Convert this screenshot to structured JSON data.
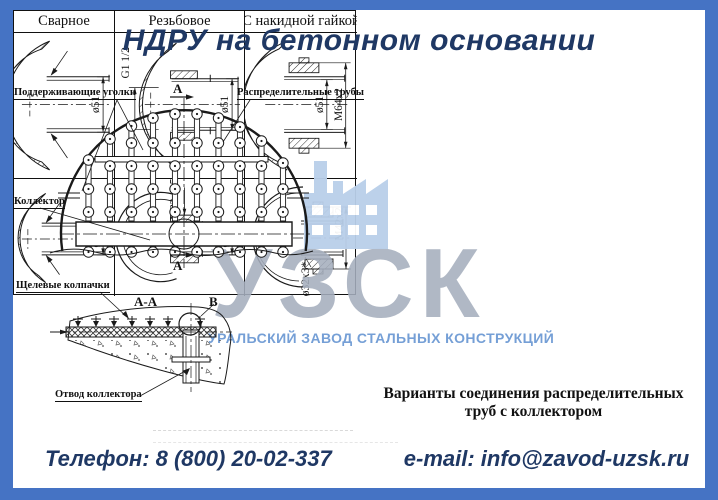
{
  "title": "НДРУ на бетонном основании",
  "plan_view": {
    "label_supports": "Поддерживающие уголки",
    "label_pipes": "Распределительные трубы",
    "label_collector": "Коллектор",
    "section_mark_top": "А",
    "section_mark_bottom": "А"
  },
  "section_view": {
    "title": "А-А",
    "label_caps": "Щелевые колпачки",
    "detail_mark": "В",
    "label_outlet": "Отвод коллектора"
  },
  "table": {
    "headers": [
      "Сварное",
      "Резьбовое",
      "С накидной гайкой"
    ],
    "cells": {
      "r1c1": {
        "dim1": "ø51"
      },
      "r1c2": {
        "dim1": "G1 1/2",
        "dim2": "ø51"
      },
      "r1c3": {
        "dim1": "ø51",
        "dim2": "M64x2"
      },
      "r2c1": {
        "dim1": "ø32"
      },
      "r2c2": {
        "dim1": "M33x1,5",
        "dim2": "ø32"
      },
      "r2c3": {
        "dim1": "M42x2",
        "dim2": "ø32x3*"
      }
    },
    "caption_line1": "Варианты соединения распределительных",
    "caption_line2": "труб с коллектором"
  },
  "watermark": {
    "acronym": "УЗСК",
    "full_name": "УРАЛЬСКИЙ ЗАВОД СТАЛЬНЫХ КОНСТРУКЦИЙ",
    "logo_icon": "factory-icon"
  },
  "footer": {
    "phone": "Телефон: 8 (800) 20-02-337",
    "email": "e-mail: info@zavod-uzsk.ru"
  },
  "colors": {
    "frame_blue": "#4573c4",
    "title_navy": "#1f3864",
    "watermark_gray": "#a6afbe",
    "watermark_blue": "#5388cc",
    "logo_blue": "#b9cfe9",
    "line_black": "#1a1a1a"
  }
}
